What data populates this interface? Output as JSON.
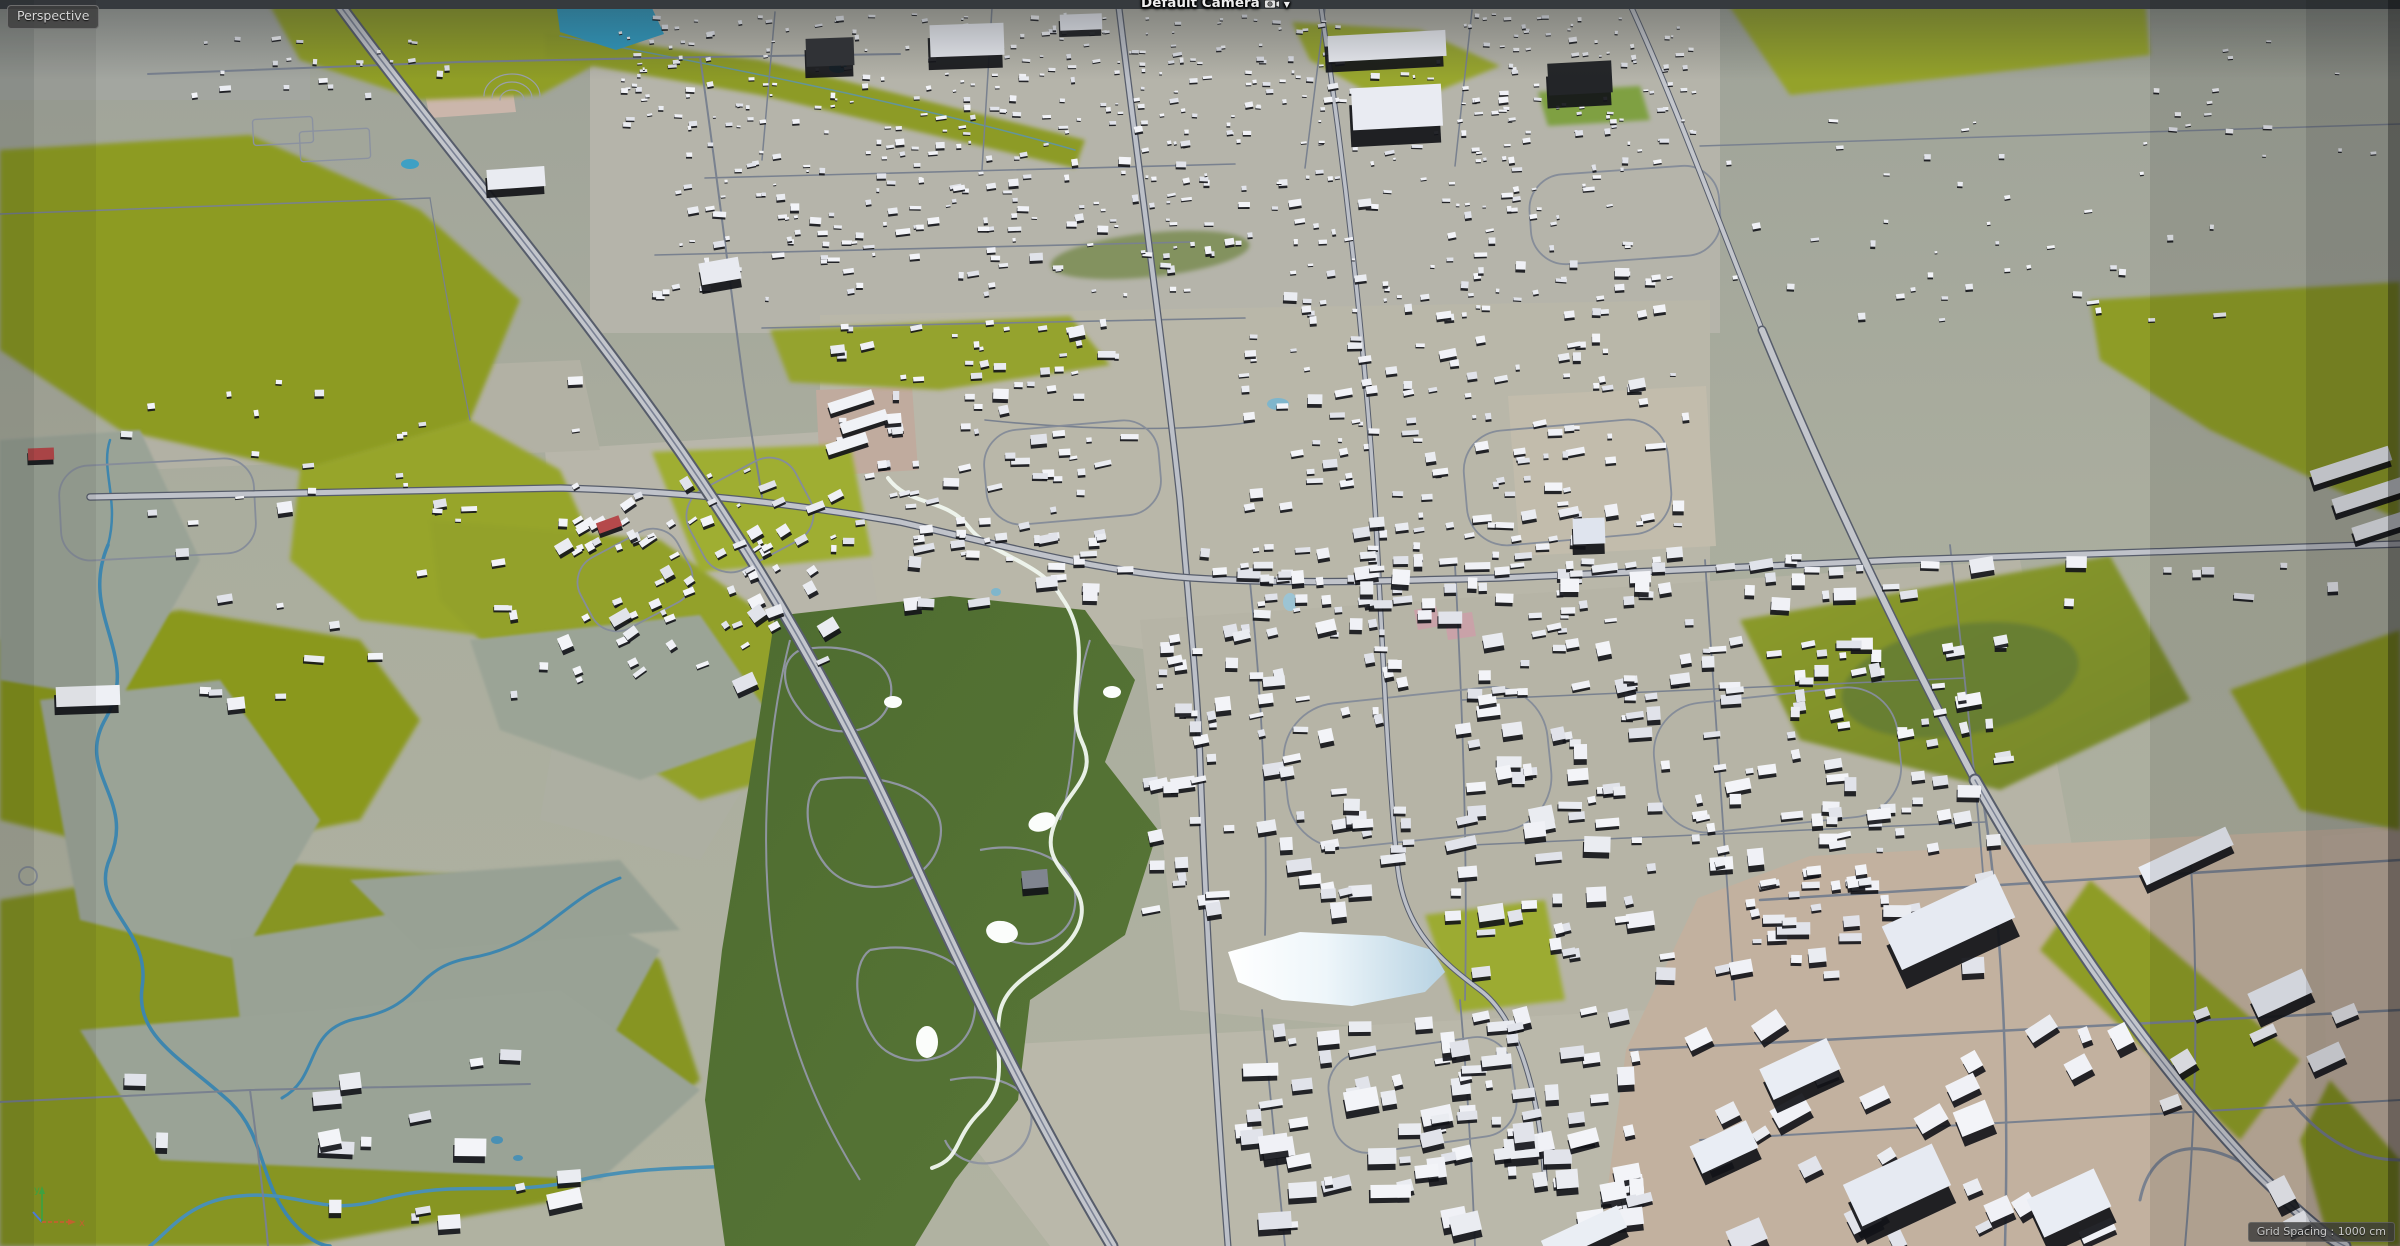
{
  "viewport": {
    "view_label": "Perspective",
    "camera_label": "Default Camera",
    "camera_dropdown_glyph": "▼",
    "grid_spacing_label": "Grid Spacing : 1000 cm"
  },
  "axis_gizmo": {
    "x_label": "x",
    "y_label": "y",
    "x_color": "#c2622e",
    "y_color": "#3fa13f",
    "z_color": "#4d7ad8"
  },
  "palette": {
    "horizon_strip": "#3b3f43",
    "terrain_base": "#a8ab9d",
    "suburb_ground": "#b6b4a8",
    "field_olive": "#8d9b24",
    "field_olive_bright": "#9fae33",
    "field_olive_dark": "#7d8c1e",
    "wetland": "#9aa396",
    "golf_green": "#4c6a2e",
    "river_blue": "#3e86ae",
    "pond_cyan": "#2f9ac0",
    "lake_white": "#f7fbfd",
    "lake_blue": "#b7d2e2",
    "road_casing": "#575d6b",
    "road_fill": "#c3c6cc",
    "road_minor": "#79818f",
    "building_top": "#eff0f5",
    "building_shadow": "#121318",
    "industrial_ground": "#c2b19f",
    "industrial_pink": "#cbb6ab",
    "red_building": "#b5494b",
    "label_background": "rgba(62,62,62,0.85)",
    "label_text": "#d8d8d8"
  },
  "scene": {
    "building_clusters": [
      {
        "name": "north-band-a",
        "x": 620,
        "y": 14,
        "w": 1080,
        "h": 120,
        "count": 340,
        "smin": 4.5,
        "smax": 10,
        "angle": -3
      },
      {
        "name": "north-band-b",
        "x": 650,
        "y": 140,
        "w": 600,
        "h": 160,
        "count": 170,
        "smin": 5,
        "smax": 11,
        "angle": -4
      },
      {
        "name": "north-right",
        "x": 1270,
        "y": 140,
        "w": 400,
        "h": 180,
        "count": 120,
        "smin": 5,
        "smax": 11,
        "angle": -4
      },
      {
        "name": "mid-west-res",
        "x": 830,
        "y": 320,
        "w": 300,
        "h": 240,
        "count": 95,
        "smin": 5,
        "smax": 12,
        "angle": -6
      },
      {
        "name": "mid-east-res",
        "x": 1240,
        "y": 335,
        "w": 450,
        "h": 300,
        "count": 175,
        "smin": 5,
        "smax": 12,
        "angle": -5
      },
      {
        "name": "west-culdesac",
        "x": 555,
        "y": 470,
        "w": 290,
        "h": 220,
        "count": 80,
        "smin": 5,
        "smax": 12,
        "angle": -28
      },
      {
        "name": "east-golf-res",
        "x": 1450,
        "y": 640,
        "w": 560,
        "h": 340,
        "count": 200,
        "smin": 6,
        "smax": 13,
        "angle": -6
      },
      {
        "name": "lake-west-res",
        "x": 1150,
        "y": 620,
        "w": 260,
        "h": 290,
        "count": 80,
        "smin": 6,
        "smax": 12,
        "angle": -6
      },
      {
        "name": "south-res",
        "x": 1240,
        "y": 1010,
        "w": 400,
        "h": 220,
        "count": 95,
        "smin": 6,
        "smax": 14,
        "angle": -8
      },
      {
        "name": "right-sparse",
        "x": 1720,
        "y": 120,
        "w": 500,
        "h": 200,
        "count": 42,
        "smin": 5,
        "smax": 10,
        "angle": -4
      },
      {
        "name": "left-rural",
        "x": 120,
        "y": 380,
        "w": 460,
        "h": 340,
        "count": 42,
        "smin": 5,
        "smax": 11,
        "angle": -3
      },
      {
        "name": "topleft-roadside",
        "x": 185,
        "y": 38,
        "w": 270,
        "h": 60,
        "count": 24,
        "smin": 6,
        "smax": 12,
        "angle": -2
      },
      {
        "name": "southwest-sparse",
        "x": 90,
        "y": 1050,
        "w": 500,
        "h": 180,
        "count": 18,
        "smin": 6,
        "smax": 12,
        "angle": -5
      },
      {
        "name": "strip-commercial",
        "x": 880,
        "y": 552,
        "w": 1480,
        "h": 52,
        "count": 64,
        "smin": 7,
        "smax": 14,
        "angle": -2
      },
      {
        "name": "topright-sparse",
        "x": 2150,
        "y": 28,
        "w": 240,
        "h": 130,
        "count": 15,
        "smin": 5,
        "smax": 9,
        "angle": -3
      },
      {
        "name": "industrial-small",
        "x": 1680,
        "y": 1010,
        "w": 680,
        "h": 230,
        "count": 36,
        "smin": 8,
        "smax": 16,
        "angle": -28
      }
    ],
    "landmarks": [
      [
        1328,
        33,
        118,
        26,
        -3,
        "#edeff5"
      ],
      [
        1352,
        86,
        90,
        42,
        -3,
        "#e9ebf2"
      ],
      [
        1548,
        62,
        64,
        32,
        -3,
        "#232528"
      ],
      [
        930,
        24,
        74,
        32,
        -2,
        "#eaecf2"
      ],
      [
        806,
        38,
        48,
        28,
        -2,
        "#303236"
      ],
      [
        1060,
        14,
        42,
        16,
        -2,
        "#e9ebf2"
      ],
      [
        828,
        396,
        46,
        11,
        -18,
        "#f0f2f6"
      ],
      [
        840,
        416,
        48,
        11,
        -18,
        "#f0f2f6"
      ],
      [
        826,
        438,
        42,
        11,
        -18,
        "#f0f2f6"
      ],
      [
        700,
        260,
        40,
        22,
        -10,
        "#e8eaf0"
      ],
      [
        487,
        168,
        58,
        20,
        -4,
        "#e9ebf1"
      ],
      [
        1573,
        518,
        32,
        26,
        -2,
        "#dfe4ee"
      ],
      [
        1886,
        898,
        125,
        48,
        -25,
        "#e6eaf2"
      ],
      [
        1763,
        1052,
        74,
        34,
        -25,
        "#e9edf4"
      ],
      [
        1693,
        1132,
        62,
        30,
        -25,
        "#e9edf4"
      ],
      [
        1848,
        1162,
        98,
        46,
        -25,
        "#e6eaf2"
      ],
      [
        2032,
        1182,
        74,
        42,
        -25,
        "#e9edf4"
      ],
      [
        1542,
        1222,
        84,
        24,
        -25,
        "#eaeef4"
      ],
      [
        2138,
        846,
        96,
        20,
        -25,
        "#e9edf4"
      ],
      [
        2250,
        980,
        60,
        26,
        -25,
        "#e9edf4"
      ],
      [
        2310,
        458,
        82,
        15,
        -18,
        "#eef0f5"
      ],
      [
        2332,
        488,
        72,
        15,
        -18,
        "#eef0f5"
      ],
      [
        2352,
        518,
        62,
        14,
        -18,
        "#eef0f5"
      ],
      [
        56,
        686,
        64,
        20,
        -2,
        "#eef0f5"
      ],
      [
        28,
        448,
        26,
        12,
        -2,
        "#b5494b"
      ],
      [
        597,
        519,
        24,
        11,
        -20,
        "#b5494b"
      ],
      [
        1022,
        870,
        26,
        18,
        -5,
        "#80858f"
      ]
    ]
  }
}
